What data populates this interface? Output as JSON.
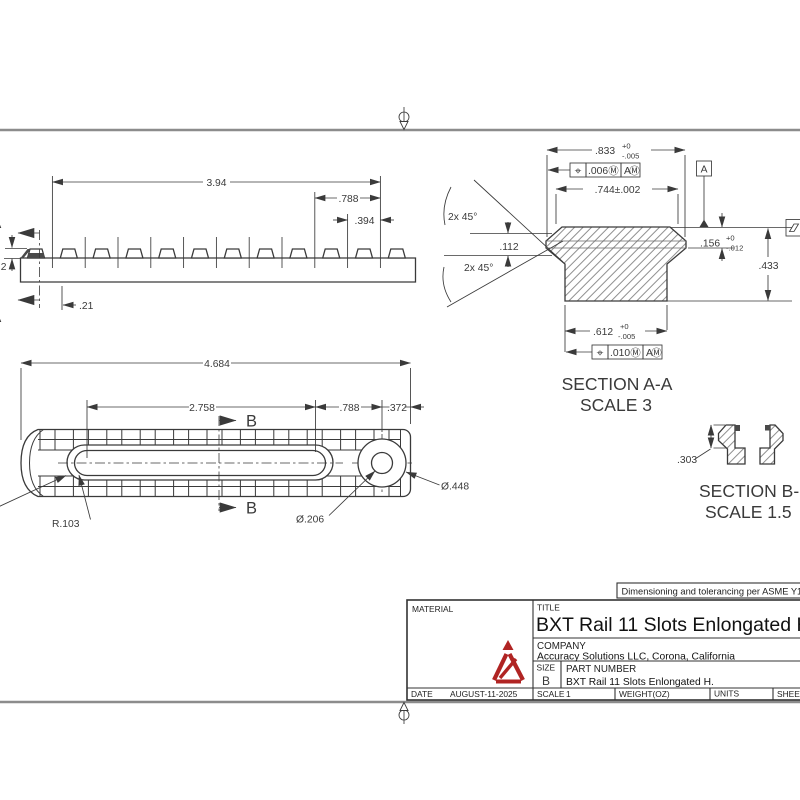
{
  "colors": {
    "line": "#3a3a3a",
    "sheet_border": "#8c8c8c",
    "logo_red": "#b02423"
  },
  "frame": {
    "note": "Dimensioning and tolerancing per ASME Y1"
  },
  "side_view": {
    "dim_overall": "3.94",
    "dim_two_pitch": ".788",
    "dim_pitch": ".394",
    "dim_end_offset": ".21",
    "dim_left_partial": "2",
    "section_letter_top": "A",
    "section_letter_bottom": "A"
  },
  "section_aa": {
    "title": "SECTION A-A",
    "scale": "SCALE 3",
    "dim_max_width": ".833",
    "dim_max_width_tol_plus": "+0",
    "dim_max_width_tol_minus": "-.005",
    "fcf_top": {
      "symbol": "⌖",
      "tolerance": ".006",
      "modifier": "Ⓜ",
      "datum": "A",
      "datum_modifier": "Ⓜ"
    },
    "dim_top_width": ".744±.002",
    "chamfer_note_upper": "2x 45°",
    "chamfer_note_lower": "2x 45°",
    "dim_rib_height": ".112",
    "dim_step": ".156",
    "dim_step_tol_plus": "+0",
    "dim_step_tol_minus": "-.012",
    "dim_height": ".433",
    "dim_base_width": ".612",
    "dim_base_tol_plus": "+0",
    "dim_base_tol_minus": "-.005",
    "fcf_bottom": {
      "symbol": "⌖",
      "tolerance": ".010",
      "modifier": "Ⓜ",
      "datum": "A",
      "datum_modifier": "Ⓜ"
    },
    "datum_label": "A"
  },
  "top_view": {
    "dim_overall": "4.684",
    "dim_slot_length": "2.758",
    "dim_two_pitch": ".788",
    "dim_end": ".372",
    "section_letter_top": "B",
    "section_letter_bottom": "B",
    "slot_radius": "R.103",
    "hole_diameter": "Ø.206",
    "cbore_diameter": "Ø.448"
  },
  "section_bb": {
    "title": "SECTION B-B",
    "scale": "SCALE 1.5",
    "dim_depth": ".303"
  },
  "title_block": {
    "material_label": "MATERIAL",
    "title_label": "TITLE",
    "title": "BXT Rail 11 Slots Enlongated H",
    "company_label": "COMPANY",
    "company": "Accuracy Solutions LLC, Corona, California",
    "size_label": "SIZE",
    "size": "B",
    "part_number_label": "PART NUMBER",
    "part_number": "BXT Rail 11 Slots Enlongated H.",
    "date_label": "DATE",
    "date": "AUGUST-11-2025",
    "scale_label": "SCALE",
    "scale": "1",
    "weight_label": "WEIGHT(OZ)",
    "units_label": "UNITS",
    "sheet_label": "SHEET"
  }
}
